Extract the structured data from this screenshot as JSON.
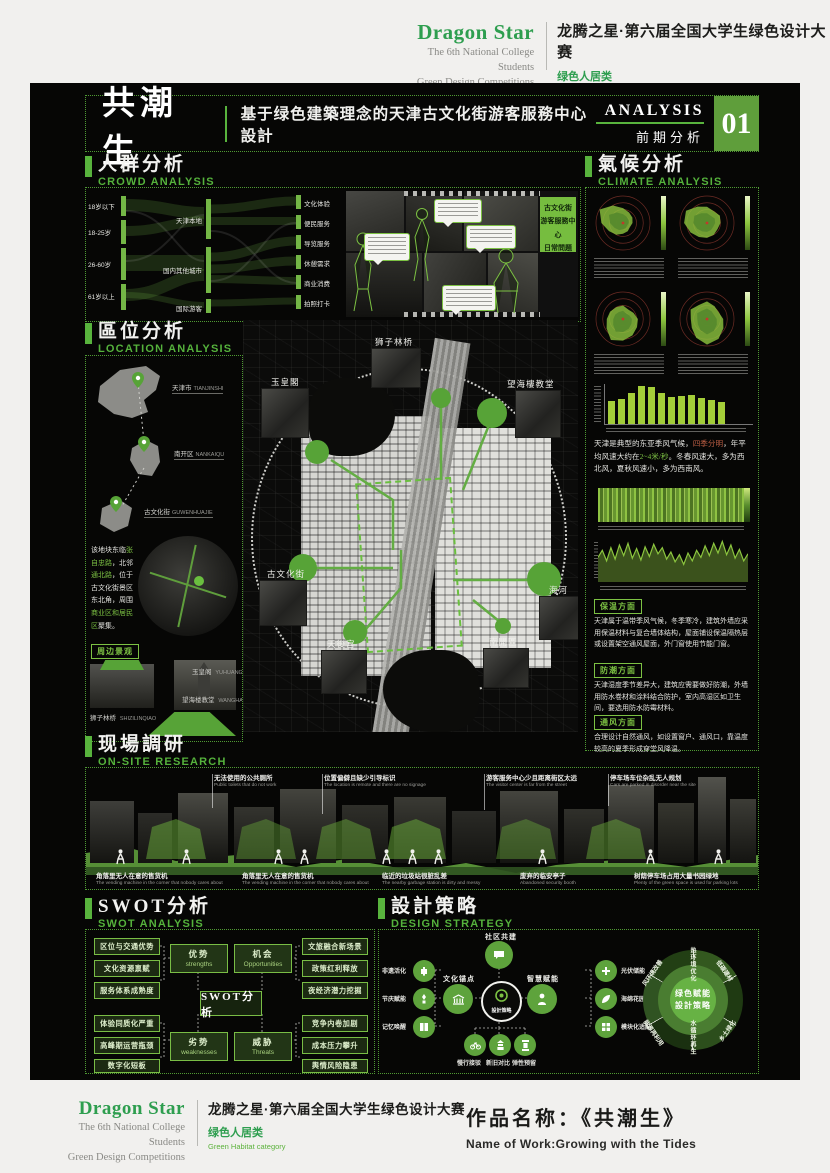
{
  "brand": {
    "name": "Dragon Star",
    "sub1": "The 6th National College Students",
    "sub2": "Green Design Competitions",
    "competition": "龙腾之星·第六届全国大学生绿色设计大赛",
    "category_cn": "绿色人居类",
    "category_en": "Green Habitat category"
  },
  "titlebar": {
    "title": "共潮生",
    "subtitle": "基于绿色建築理念的天津古文化街游客服務中心設計",
    "analysis_en": "ANALYSIS",
    "analysis_cn": "前期分析",
    "page_num": "01"
  },
  "colors": {
    "accent": "#58b33d",
    "box_green": "#5f9e3b",
    "flow_green": "#74b746",
    "poster_bg": "#060605"
  },
  "crowd": {
    "title_cn": "人群分析",
    "title_en": "CROWD ANALYSIS",
    "sankey": {
      "left": [
        "18岁以下",
        "18-25岁",
        "26-60岁",
        "61岁以上"
      ],
      "middle": [
        "天津本地",
        "国内其他城市",
        "国际游客"
      ],
      "right": [
        "文化体验",
        "便民服务",
        "导览服务",
        "休憩需求",
        "商业消费",
        "拍照打卡"
      ]
    },
    "badge_lines": [
      "古文化街",
      "游客服務中心",
      "日常問題"
    ]
  },
  "climate": {
    "title_cn": "氣候分析",
    "title_en": "CLIMATE ANALYSIS",
    "para_segments": [
      {
        "t": "天津是典型的东亚季风气候，",
        "c": "w"
      },
      {
        "t": "四季分明",
        "c": "r"
      },
      {
        "t": "，年平均风速大约在",
        "c": "w"
      },
      {
        "t": "2~4米/秒",
        "c": "g"
      },
      {
        "t": "。冬春风速大，多为西北风，夏秋风速小，多为西南风。",
        "c": "w"
      }
    ],
    "notes": [
      {
        "label": "保温方面",
        "text": "天津属于温带季风气候，冬季寒冷，建筑外墙应采用保温材料与复合墙体结构，屋面铺设保温隔热层或设置架空通风屋面，外门窗使用节能门窗。"
      },
      {
        "label": "防潮方面",
        "text": "天津湿度季节差异大，建筑应需要做好防潮，外墙用防水卷材和涂料结合防护，室内高湿区如卫生间，要选用防水防霉材料。"
      },
      {
        "label": "通风方面",
        "text": "合理设计自然通风，如设置窗户、通风口，靠温度较高的夏季形成穿堂风降温。"
      }
    ]
  },
  "location": {
    "title_cn": "區位分析",
    "title_en": "LOCATION ANALYSIS",
    "pins": [
      {
        "cn": "天津市",
        "en": "TIANJINSHI"
      },
      {
        "cn": "南开区",
        "en": "NANKAIQU"
      },
      {
        "cn": "古文化街",
        "en": "GUWENHUAJIE"
      }
    ],
    "para_segments": [
      {
        "t": "该地块东临",
        "c": "w"
      },
      {
        "t": "张自忠路",
        "c": "g"
      },
      {
        "t": "，北邻",
        "c": "w"
      },
      {
        "t": "通北路",
        "c": "g"
      },
      {
        "t": "，位于古文化街景区东北角，周围",
        "c": "w"
      },
      {
        "t": "商业区和居民区",
        "c": "g"
      },
      {
        "t": "聚集。",
        "c": "w"
      }
    ],
    "surround_label": "周边景观",
    "landmarks": [
      {
        "cn": "玉皇阁",
        "en": "YUHUANGGE"
      },
      {
        "cn": "狮子林桥",
        "en": "SHIZILINQIAO"
      },
      {
        "cn": "望海楼教堂",
        "en": "WANGHAILOU"
      }
    ]
  },
  "map": {
    "labels": [
      "狮子林桥",
      "玉皇閣",
      "望海樓教堂",
      "古文化街",
      "海河",
      "天後宫",
      "南開區"
    ]
  },
  "onsite": {
    "title_cn": "现場調研",
    "title_en": "ON-SITE RESEARCH",
    "top_notes": [
      {
        "cn": "无法使用的公共厕所",
        "en": "Public toilets that do not work"
      },
      {
        "cn": "位置偏僻且缺少引导标识",
        "en": "The location is remote and there are no signage"
      },
      {
        "cn": "游客服务中心少且距离街区太远",
        "en": "The visitor center is far from the street"
      },
      {
        "cn": "停车场车位杂乱无人规划",
        "en": "Cars are parked in disorder near the site"
      }
    ],
    "bottom_notes": [
      {
        "cn": "角落里无人在意的售货机",
        "en": "The vending machine in the corner that nobody cares about"
      },
      {
        "cn": "角落里无人在意的售货机",
        "en": "The vending machine in the corner that nobody cares about"
      },
      {
        "cn": "临近的垃圾站很脏乱差",
        "en": "The nearby garbage station is dirty and messy"
      },
      {
        "cn": "废弃的临安亭子",
        "en": "Abandoned security booth"
      },
      {
        "cn": "树荫停车场占用大量书园绿地",
        "en": "Plenty of the green space is used for parking lots"
      }
    ]
  },
  "swot": {
    "title_cn": "SWOT分析",
    "title_en": "SWOT ANALYSIS",
    "center": "SWOT分析",
    "quads": {
      "strengths": {
        "cn": "优势",
        "en": "strengths",
        "items": [
          "区位与交通优势",
          "文化资源禀赋",
          "服务体系成熟度"
        ]
      },
      "weaknesses": {
        "cn": "劣势",
        "en": "weaknesses",
        "items": [
          "体验同质化严重",
          "高峰期运营瓶颈",
          "数字化短板"
        ]
      },
      "opportunities": {
        "cn": "机会",
        "en": "Opportunities",
        "items": [
          "文旅融合新场景",
          "政策红利释放",
          "夜经济潜力挖掘"
        ]
      },
      "threats": {
        "cn": "威胁",
        "en": "Threats",
        "items": [
          "竞争内卷加剧",
          "成本压力攀升",
          "舆情风险隐患"
        ]
      }
    }
  },
  "strategy": {
    "title_cn": "設計策略",
    "title_en": "DESIGN STRATEGY",
    "center": "設計策略",
    "top": "社区共建",
    "left_hub": "文化锚点",
    "right_hub": "智慧赋能",
    "left_items": [
      "非遗活化",
      "节庆赋能",
      "记忆唤醒"
    ],
    "right_items": [
      "光伏储能",
      "海绵花园",
      "模块化适配"
    ],
    "bottom_items": [
      "慢行接驳",
      "新旧对比",
      "弹性预留"
    ],
    "wheel": {
      "center_l1": "绿色赋能",
      "center_l2": "設計策略",
      "segments": [
        "热环境优化",
        "低碳建材",
        "乡土绿化",
        "水循环再生",
        "能源再利用",
        "风环境改善"
      ]
    }
  },
  "footer": {
    "work_label": "作品名称：《共潮生》",
    "work_en": "Name of Work:Growing with the Tides"
  },
  "chart_data": [
    {
      "type": "polar",
      "title": "季节风频玫瑰图（4幅）",
      "note": "green radial wind-frequency roses on dark ground with red ring grid and green colorbar",
      "series": [
        {
          "name": "rose-1",
          "values": [
            0.55,
            0.45,
            0.4,
            0.35,
            0.3,
            0.35,
            0.4,
            0.5,
            0.6,
            0.8,
            1.0,
            0.75
          ]
        },
        {
          "name": "rose-2",
          "values": [
            0.6,
            0.5,
            0.55,
            0.5,
            0.45,
            0.5,
            0.55,
            0.6,
            0.7,
            0.85,
            0.9,
            0.7
          ]
        },
        {
          "name": "rose-3",
          "values": [
            0.5,
            0.4,
            0.45,
            0.55,
            0.6,
            0.7,
            0.8,
            0.9,
            0.7,
            0.6,
            0.55,
            0.5
          ]
        },
        {
          "name": "rose-4",
          "values": [
            0.65,
            0.55,
            0.5,
            0.6,
            0.7,
            0.85,
            0.95,
            0.8,
            0.65,
            0.6,
            0.7,
            0.6
          ]
        }
      ]
    },
    {
      "type": "bar",
      "title": "月平均风速",
      "categories": [
        "1",
        "2",
        "3",
        "4",
        "5",
        "6",
        "7",
        "8",
        "9",
        "10",
        "11",
        "12"
      ],
      "values": [
        2.3,
        2.5,
        3.1,
        3.8,
        3.7,
        3.1,
        2.7,
        2.8,
        2.9,
        2.6,
        2.4,
        2.2
      ],
      "ylabel": "m/s",
      "ylim": [
        0,
        4
      ]
    },
    {
      "type": "heatmap",
      "title": "全年逐时风速分布",
      "note": "horizontal green intensity strip, brighter bands in winter/spring months"
    },
    {
      "type": "line",
      "title": "全年风速波动",
      "values": [
        2.8,
        3.6,
        2.4,
        3.9,
        2.6,
        4.2,
        3.0,
        4.4,
        2.7,
        3.8,
        2.5,
        4.0,
        2.9,
        4.3,
        3.2,
        3.9,
        2.6,
        3.4,
        2.3,
        3.1,
        2.0,
        3.3,
        2.4,
        3.6,
        2.8,
        4.1,
        3.0,
        4.4,
        3.3,
        4.6,
        3.1,
        4.2,
        2.7,
        3.7,
        2.4,
        3.2
      ],
      "ylim": [
        0,
        5
      ]
    }
  ]
}
